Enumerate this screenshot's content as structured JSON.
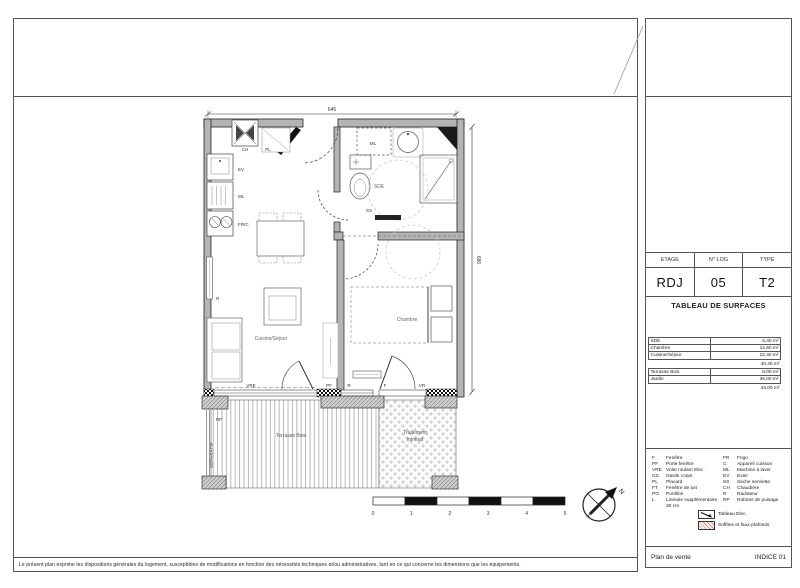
{
  "colors": {
    "wall": "#b4b4b4",
    "door_arc": "#4a4a80",
    "soffit_hatch": "#cf8f78"
  },
  "plan": {
    "dimensions": {
      "width": "645",
      "height": "680"
    },
    "rooms": {
      "kitchen_living": "Cuisine/Séjour",
      "bedroom": "Chambre",
      "shower_room": "SDE",
      "terrace": "Terrasse Bois",
      "mineral_1": "Traitement",
      "mineral_2": "minéral",
      "separator": "SÉPARATIF"
    },
    "equipment": {
      "ch": "CH",
      "pl": "PL",
      "ev": "EV",
      "ml_kitchen": "ML",
      "frc": "FR/C",
      "ml_sde": "ML",
      "ss": "SS",
      "r_living": "R",
      "r_bedroom": "R",
      "vre": "VRE",
      "pf": "PF",
      "f": "F",
      "vr": "VR",
      "rp": "RP"
    },
    "scale_ticks": [
      "0",
      "1",
      "2",
      "3",
      "4",
      "5"
    ],
    "north": "N"
  },
  "title_block": {
    "info": {
      "labels": [
        "ETAGE",
        "N° LOG",
        "TYPE"
      ],
      "values": [
        "RDJ",
        "05",
        "T2"
      ]
    },
    "surfaces": {
      "title": "TABLEAU DE SURFACES",
      "rows": [
        {
          "name": "SDE",
          "value": "5,40 m²"
        },
        {
          "name": "Chambre",
          "value": "12,60 m²"
        },
        {
          "name": "Cuisine/Séjour",
          "value": "22,40 m²"
        }
      ],
      "subtotal": "40,40 m²",
      "ext_rows": [
        {
          "name": "Terrasse Bois",
          "value": "8,00 m²"
        },
        {
          "name": "Jardin",
          "value": "36,00 m²"
        }
      ],
      "total": "44,00 m²"
    },
    "legend": {
      "col1": [
        {
          "abbr": "F",
          "label": "Fenêtre"
        },
        {
          "abbr": "PF",
          "label": "Porte fenêtre"
        },
        {
          "abbr": "VRE",
          "label": "Volet roulant Elec."
        },
        {
          "abbr": "GC",
          "label": "Garde corps"
        },
        {
          "abbr": "PL",
          "label": "Placard"
        },
        {
          "abbr": "FT",
          "label": "Fenêtre de toit"
        },
        {
          "abbr": "PO",
          "label": "Portillon"
        },
        {
          "abbr": "L",
          "label": "Linéaire supplémentaire 30 cm"
        }
      ],
      "col2": [
        {
          "abbr": "FR",
          "label": "Frigo"
        },
        {
          "abbr": "C",
          "label": "Appareil cuisson"
        },
        {
          "abbr": "ML",
          "label": "Machine à laver"
        },
        {
          "abbr": "EV",
          "label": "Evier"
        },
        {
          "abbr": "SS",
          "label": "Sèche serviette"
        },
        {
          "abbr": "CH",
          "label": "Chaudière"
        },
        {
          "abbr": "R",
          "label": "Radiateur"
        },
        {
          "abbr": "RP",
          "label": "Robinet de puisage"
        }
      ],
      "symbols": [
        {
          "label": "Tableau Elec."
        },
        {
          "label": "Soffites et faux-plafonds"
        }
      ]
    },
    "footer": {
      "left": "Plan de vente",
      "right": "INDICE 01"
    }
  },
  "disclaimer": "Le présent plan exprime les dispositions générales du logement, susceptibles de modifications en fonction des nécessités techniques et/ou administratives, tant en ce qui concerne les dimensions que les équipements."
}
